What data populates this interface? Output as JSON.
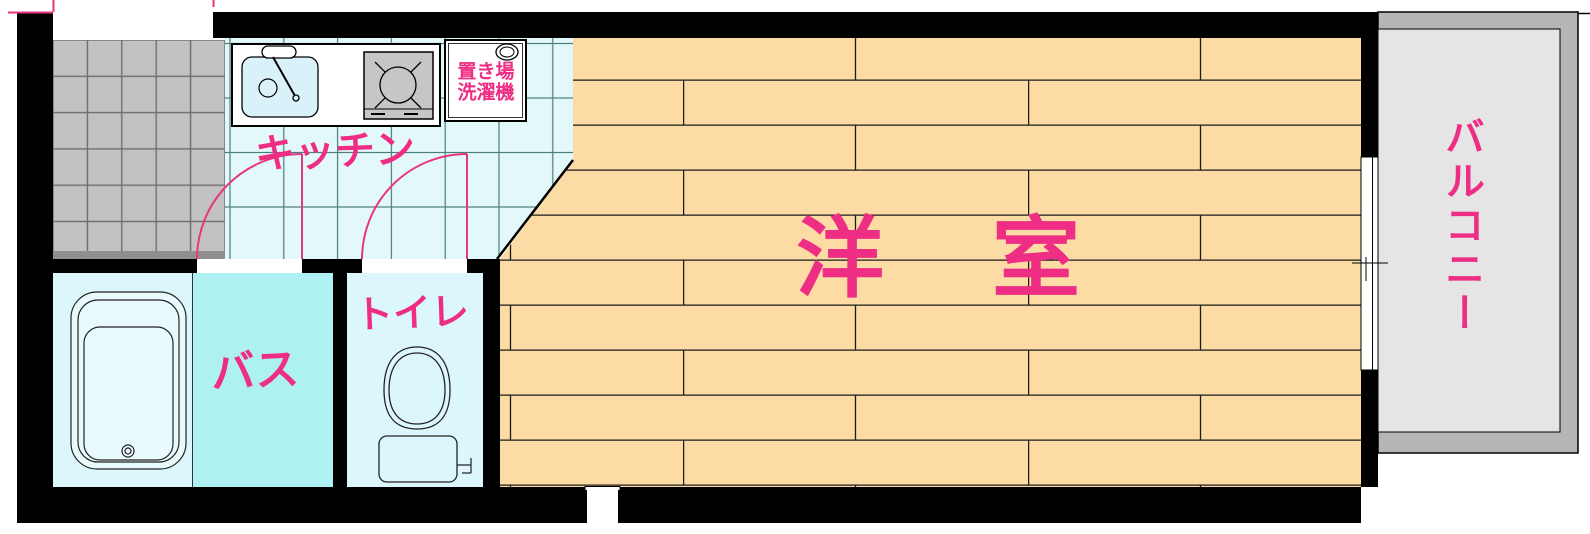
{
  "plan": {
    "title": "one-room apartment floor plan",
    "rooms": {
      "kitchen": {
        "label": "キッチン"
      },
      "western_room": {
        "label": "洋　室"
      },
      "bath": {
        "label": "バス"
      },
      "toilet": {
        "label": "トイレ"
      },
      "balcony": {
        "label": "バルコニー"
      },
      "washer_place": {
        "line1": "置き場",
        "line2": "洗濯機"
      }
    },
    "colors": {
      "label_pink": "#ee2d84",
      "door_swing_pink": "#e8357f",
      "wood_floor": "#fcdca4",
      "kitchen_floor": "#e3f8f8",
      "kitchen_grid_line": "#4b7d7d",
      "bath_floor": "#aef1f3",
      "bath_room_floor": "#dcf7fb",
      "entrance_tile": "#c2c2c2",
      "balcony_outer": "#b5b5b5",
      "balcony_inner": "#e5e5e5",
      "stove": "#c6c6c6",
      "sink": "#d9f1f9",
      "wall": "#000000"
    }
  }
}
